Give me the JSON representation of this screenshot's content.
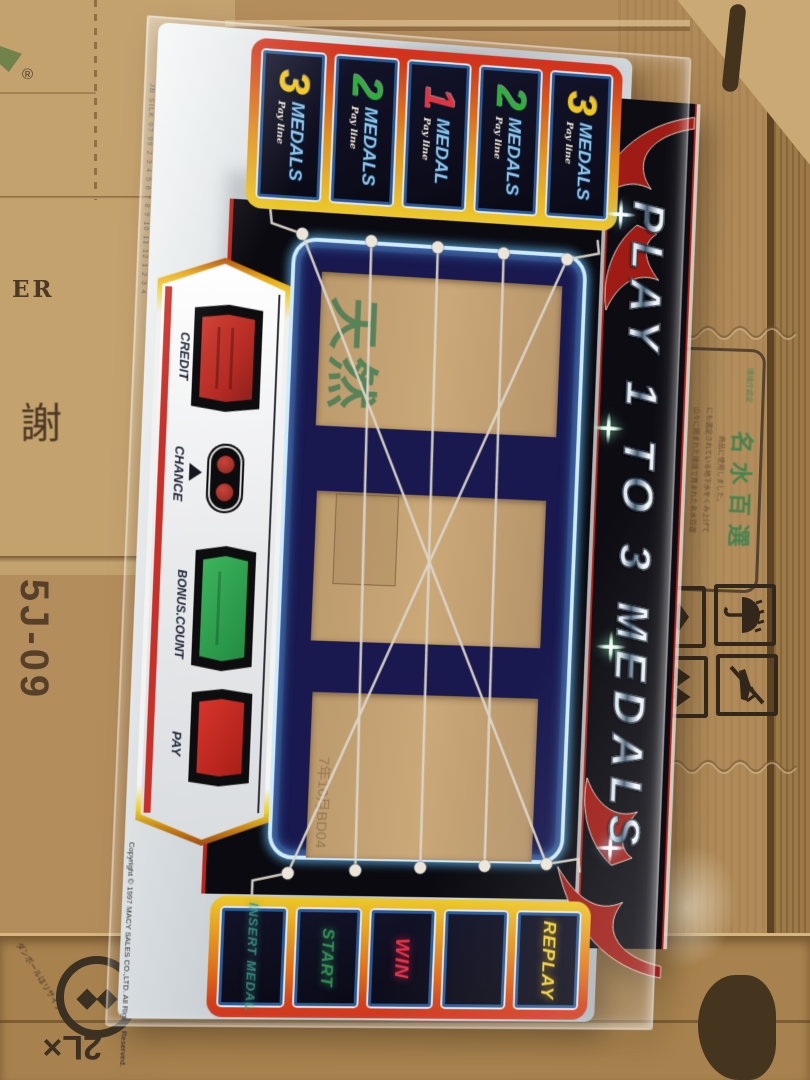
{
  "cardboard": {
    "registered_mark": "®",
    "er_text": "ER",
    "kanji_sha": "謝",
    "box_code": "5J-09",
    "bottle_size": "2L×",
    "recycle_label": "ダンボールはリサイクル",
    "stamp": {
      "header": "環境庁認定",
      "title": "名水百選",
      "lines": [
        "山々に囲まれた環境で育まれた名水百選",
        "にも選定されている地下水をくみ上げて",
        "商品に使用しました。"
      ]
    }
  },
  "panel": {
    "edge_print": "JB SILK   97   99   2 3 4 5 6 7 8 9 10 11 12   1 2 3 4",
    "paylines_top": [
      {
        "num": "3",
        "word": "MEDALS",
        "sub": "Pay line"
      },
      {
        "num": "2",
        "word": "MEDALS",
        "sub": "Pay line"
      },
      {
        "num": "1",
        "word": "MEDAL",
        "sub": "Pay line"
      },
      {
        "num": "2",
        "word": "MEDALS",
        "sub": "Pay line"
      },
      {
        "num": "3",
        "word": "MEDALS",
        "sub": "Pay line"
      }
    ],
    "num_colors": [
      "#f2c61c",
      "#2fae3c",
      "#e23440",
      "#2fae3c",
      "#f2c61c"
    ],
    "console": {
      "credit": "CREDIT",
      "chance": "CHANCE",
      "bonus": "BONUS.COUNT",
      "pay": "PAY"
    },
    "title": "PLAY 1 TO 3 MEDALS",
    "window": {
      "kanji": "天然",
      "stamp": "7年10月BD04"
    },
    "buttons": [
      "INSERT MEDAL",
      "START",
      "WIN",
      "",
      "REPLAY"
    ],
    "copyright": "Copyright © 1997 MACY SALES CO.,LTD. All Rights Reserved.",
    "accent_colors": {
      "frame_red": "#d02a18",
      "frame_yellow": "#ecc92c",
      "neon_blue": "#cfeafc",
      "credit_screen": "#c23830",
      "bonus_screen": "#2f9e4e",
      "pay_screen": "#cc2a22",
      "win_text": "#e63448",
      "replay_text": "#eecf3a",
      "start_text": "#36a05c",
      "insert_text": "#3d9488"
    }
  }
}
